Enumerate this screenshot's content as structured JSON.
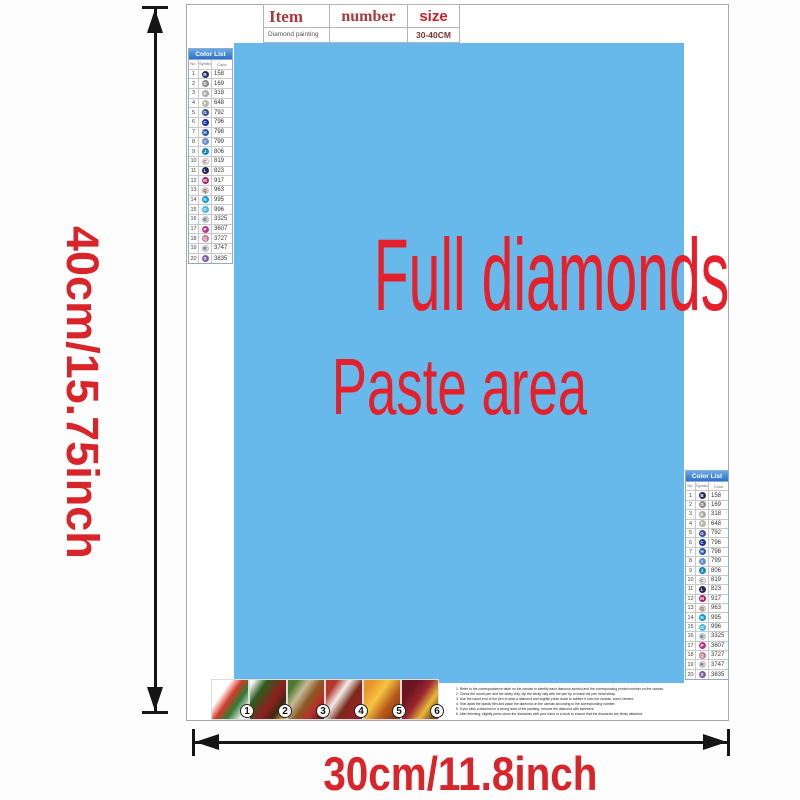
{
  "item_table": {
    "col_item": "Item",
    "col_number": "number",
    "col_size": "size",
    "row_item": "Diamond painting",
    "row_number": "",
    "row_size": "30-40CM"
  },
  "paste_area": {
    "title": "Full diamonds",
    "subtitle": "Paste area",
    "bg_color": "#66b9ea",
    "text_color": "#e5202a"
  },
  "dimensions": {
    "height_label": "40cm/15.75inch",
    "width_label": "30cm/11.8inch",
    "label_color": "#d9252a"
  },
  "color_list": {
    "title": "Color List",
    "col_no": "No.",
    "col_symbol": "Symbol",
    "col_color": "Color",
    "rows": [
      {
        "no": "1",
        "symbol": "B",
        "hex": "#1f2f5e",
        "light": false,
        "code": "158"
      },
      {
        "no": "2",
        "symbol": "D",
        "hex": "#8a8a8a",
        "light": false,
        "code": "169"
      },
      {
        "no": "3",
        "symbol": "E",
        "hex": "#a9a9a9",
        "light": false,
        "code": "318"
      },
      {
        "no": "4",
        "symbol": "F",
        "hex": "#b6b8ad",
        "light": false,
        "code": "648"
      },
      {
        "no": "5",
        "symbol": "G",
        "hex": "#3a4a9f",
        "light": false,
        "code": "792"
      },
      {
        "no": "6",
        "symbol": "C",
        "hex": "#16309c",
        "light": false,
        "code": "796"
      },
      {
        "no": "7",
        "symbol": "H",
        "hex": "#2d55b0",
        "light": false,
        "code": "798"
      },
      {
        "no": "8",
        "symbol": "I",
        "hex": "#6b8fd0",
        "light": false,
        "code": "799"
      },
      {
        "no": "9",
        "symbol": "J",
        "hex": "#1387b5",
        "light": false,
        "code": "806"
      },
      {
        "no": "10",
        "symbol": "C",
        "hex": "#f8e8e4",
        "light": true,
        "code": "819"
      },
      {
        "no": "11",
        "symbol": "L",
        "hex": "#1b2a55",
        "light": false,
        "code": "823"
      },
      {
        "no": "12",
        "symbol": "M",
        "hex": "#a1246b",
        "light": false,
        "code": "917"
      },
      {
        "no": "13",
        "symbol": "Q",
        "hex": "#f6cdc4",
        "light": true,
        "code": "963"
      },
      {
        "no": "14",
        "symbol": "N",
        "hex": "#0e9ad8",
        "light": false,
        "code": "995"
      },
      {
        "no": "15",
        "symbol": "O",
        "hex": "#3cb9e8",
        "light": false,
        "code": "996"
      },
      {
        "no": "16",
        "symbol": "K",
        "hex": "#b9d3ec",
        "light": true,
        "code": "3325"
      },
      {
        "no": "17",
        "symbol": "P",
        "hex": "#b5368f",
        "light": false,
        "code": "3607"
      },
      {
        "no": "18",
        "symbol": "Q",
        "hex": "#c4798f",
        "light": false,
        "code": "3727"
      },
      {
        "no": "19",
        "symbol": "R",
        "hex": "#d6d6ee",
        "light": true,
        "code": "3747"
      },
      {
        "no": "20",
        "symbol": "S",
        "hex": "#7e5e9e",
        "light": false,
        "code": "3835"
      }
    ]
  },
  "instructions": {
    "step_labels": [
      "1",
      "2",
      "3",
      "4",
      "5",
      "6"
    ],
    "lines": [
      "1. Refer to the correspondence table on the canvas to identify each diamond symbol and the corresponding printed number on the canvas.",
      "2. Check the round pen and the sticky clay, dip the sticky clay with the pen tip to make the pen head sticky.",
      "3. Use the round end of the pen to stick a diamond and slightly press down to adhere it onto the canvas, some cement.",
      "4. Tear apart the plastic film and place the diamond on the canvas according to the corresponding number.",
      "5. If you stick a diamond in a wrong area of the painting, remove the diamond with tweezers.",
      "6. After finishing, slightly press down the diamonds with your hand or a book to ensure that the diamonds are firmly attached."
    ]
  }
}
